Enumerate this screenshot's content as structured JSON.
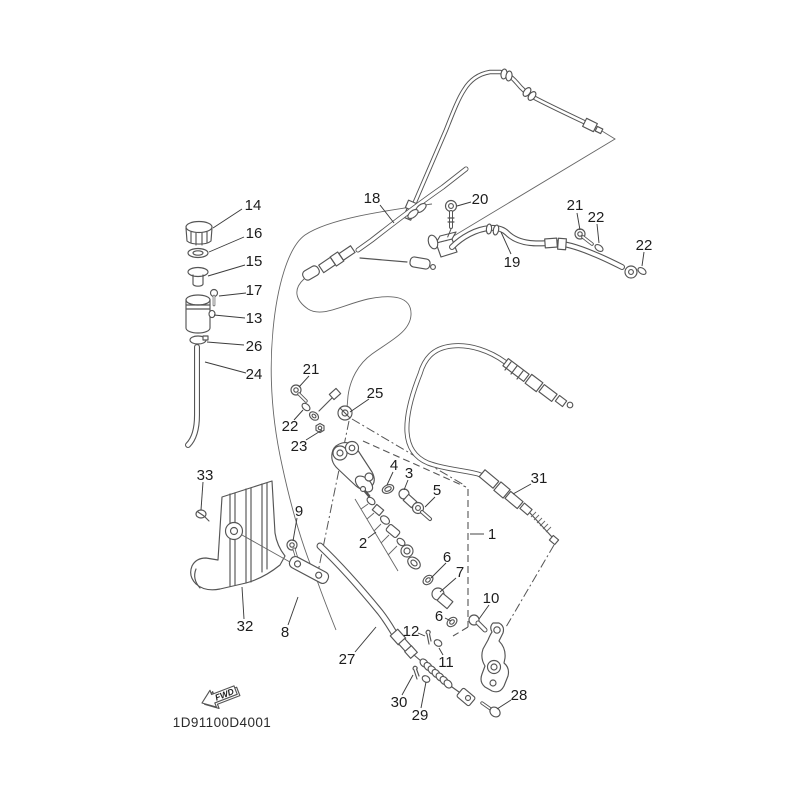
{
  "drawing_code": "1D91100D4001",
  "fwd_arrow": {
    "label": "FWD"
  },
  "colors": {
    "background": "#ffffff",
    "line": "#555555",
    "label_text": "#1d1d1d"
  },
  "callouts": [
    {
      "ref": "14",
      "x": 253,
      "y": 205,
      "leader": [
        [
          242,
          209
        ],
        [
          213,
          228
        ]
      ]
    },
    {
      "ref": "16",
      "x": 254,
      "y": 233,
      "leader": [
        [
          244,
          237
        ],
        [
          209,
          252
        ]
      ]
    },
    {
      "ref": "15",
      "x": 254,
      "y": 261,
      "leader": [
        [
          245,
          265
        ],
        [
          208,
          276
        ]
      ]
    },
    {
      "ref": "17",
      "x": 254,
      "y": 290,
      "leader": [
        [
          246,
          293
        ],
        [
          219,
          296
        ]
      ]
    },
    {
      "ref": "13",
      "x": 254,
      "y": 318,
      "leader": [
        [
          245,
          318
        ],
        [
          214,
          315
        ]
      ]
    },
    {
      "ref": "26",
      "x": 254,
      "y": 346,
      "leader": [
        [
          244,
          345
        ],
        [
          207,
          342
        ]
      ]
    },
    {
      "ref": "24",
      "x": 254,
      "y": 374,
      "leader": [
        [
          246,
          373
        ],
        [
          205,
          362
        ]
      ]
    },
    {
      "ref": "18",
      "x": 372,
      "y": 198,
      "leader": [
        [
          380,
          205
        ],
        [
          394,
          223
        ]
      ]
    },
    {
      "ref": "20",
      "x": 480,
      "y": 199,
      "leader": [
        [
          471,
          202
        ],
        [
          457,
          206
        ]
      ]
    },
    {
      "ref": "19",
      "x": 512,
      "y": 262,
      "leader": [
        [
          511,
          254
        ],
        [
          501,
          232
        ]
      ]
    },
    {
      "ref": "21",
      "x": 575,
      "y": 205,
      "leader": [
        [
          577,
          213
        ],
        [
          580,
          230
        ]
      ]
    },
    {
      "ref": "22",
      "x": 596,
      "y": 217,
      "leader": [
        [
          597,
          224
        ],
        [
          599,
          243
        ]
      ]
    },
    {
      "ref": "22",
      "x": 644,
      "y": 245,
      "leader": [
        [
          644,
          252
        ],
        [
          642,
          266
        ]
      ]
    },
    {
      "ref": "21",
      "x": 311,
      "y": 369,
      "leader": [
        [
          309,
          376
        ],
        [
          299,
          387
        ]
      ]
    },
    {
      "ref": "22",
      "x": 290,
      "y": 426,
      "leader": [
        [
          294,
          420
        ],
        [
          303,
          410
        ]
      ]
    },
    {
      "ref": "23",
      "x": 299,
      "y": 446,
      "leader": [
        [
          306,
          440
        ],
        [
          322,
          430
        ]
      ]
    },
    {
      "ref": "25",
      "x": 375,
      "y": 393,
      "leader": [
        [
          369,
          399
        ],
        [
          350,
          412
        ]
      ]
    },
    {
      "ref": "4",
      "x": 394,
      "y": 465,
      "leader": [
        [
          393,
          472
        ],
        [
          387,
          485
        ]
      ]
    },
    {
      "ref": "3",
      "x": 409,
      "y": 473,
      "leader": [
        [
          408,
          480
        ],
        [
          404,
          490
        ]
      ]
    },
    {
      "ref": "5",
      "x": 437,
      "y": 490,
      "leader": [
        [
          435,
          497
        ],
        [
          425,
          507
        ]
      ]
    },
    {
      "ref": "31",
      "x": 539,
      "y": 478,
      "leader": [
        [
          531,
          484
        ],
        [
          513,
          494
        ]
      ]
    },
    {
      "ref": "1",
      "x": 492,
      "y": 534,
      "leader": [
        [
          484,
          534
        ],
        [
          470,
          534
        ]
      ]
    },
    {
      "ref": "2",
      "x": 363,
      "y": 543,
      "leader": [
        [
          368,
          538
        ],
        [
          376,
          532
        ]
      ]
    },
    {
      "ref": "6",
      "x": 447,
      "y": 557,
      "leader": [
        [
          446,
          563
        ],
        [
          431,
          578
        ]
      ]
    },
    {
      "ref": "7",
      "x": 460,
      "y": 572,
      "leader": [
        [
          456,
          578
        ],
        [
          440,
          592
        ]
      ]
    },
    {
      "ref": "6",
      "x": 439,
      "y": 616,
      "leader": [
        [
          445,
          618
        ],
        [
          451,
          621
        ]
      ]
    },
    {
      "ref": "10",
      "x": 491,
      "y": 598,
      "leader": [
        [
          489,
          605
        ],
        [
          479,
          619
        ]
      ]
    },
    {
      "ref": "12",
      "x": 411,
      "y": 631,
      "leader": [
        [
          418,
          633
        ],
        [
          425,
          636
        ]
      ]
    },
    {
      "ref": "11",
      "x": 446,
      "y": 662,
      "leader": [
        [
          443,
          655
        ],
        [
          439,
          648
        ]
      ]
    },
    {
      "ref": "33",
      "x": 205,
      "y": 475,
      "leader": [
        [
          203,
          482
        ],
        [
          201,
          510
        ]
      ]
    },
    {
      "ref": "9",
      "x": 299,
      "y": 511,
      "leader": [
        [
          297,
          518
        ],
        [
          293,
          541
        ]
      ]
    },
    {
      "ref": "32",
      "x": 245,
      "y": 626,
      "leader": [
        [
          244,
          619
        ],
        [
          242,
          587
        ]
      ]
    },
    {
      "ref": "8",
      "x": 285,
      "y": 632,
      "leader": [
        [
          288,
          625
        ],
        [
          298,
          597
        ]
      ]
    },
    {
      "ref": "27",
      "x": 347,
      "y": 659,
      "leader": [
        [
          355,
          652
        ],
        [
          376,
          627
        ]
      ]
    },
    {
      "ref": "30",
      "x": 399,
      "y": 702,
      "leader": [
        [
          402,
          695
        ],
        [
          413,
          675
        ]
      ]
    },
    {
      "ref": "29",
      "x": 420,
      "y": 715,
      "leader": [
        [
          421,
          708
        ],
        [
          426,
          682
        ]
      ]
    },
    {
      "ref": "28",
      "x": 519,
      "y": 695,
      "leader": [
        [
          511,
          700
        ],
        [
          497,
          709
        ]
      ]
    }
  ]
}
